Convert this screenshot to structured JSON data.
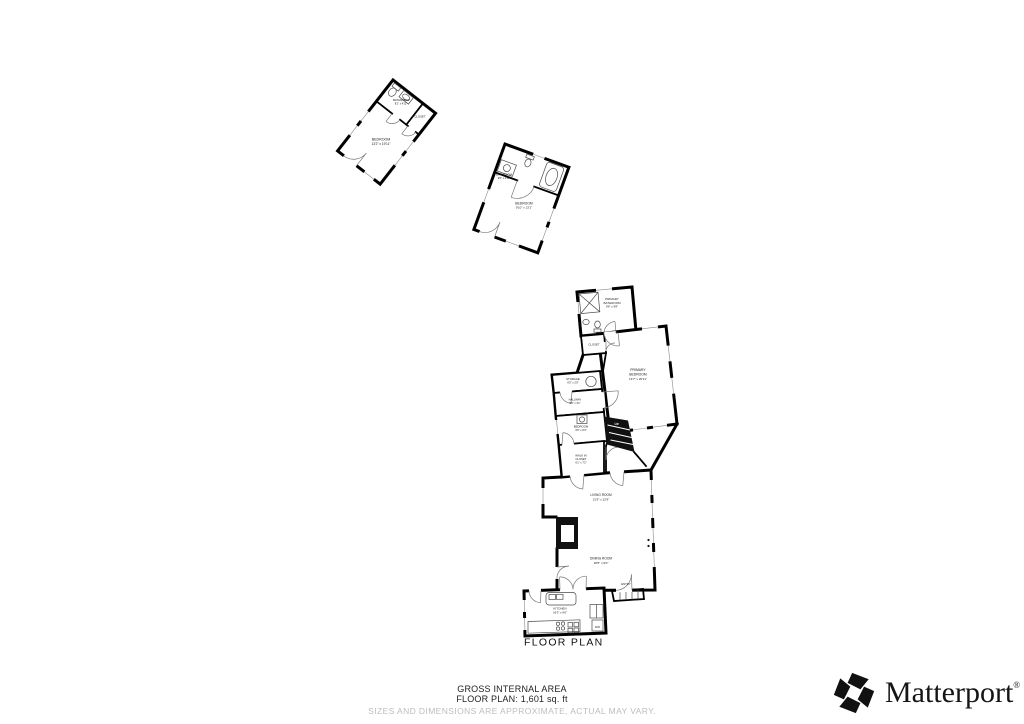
{
  "plan": {
    "colors": {
      "wall": "#000000",
      "fixture": "#4a4a4a",
      "window_line": "#8a8a8a",
      "door_arc": "#777777",
      "label": "#1a1a1a",
      "disclaimer": "#bdbdbd",
      "brand": "#111111"
    },
    "rooms": {
      "adu1_bathroom": {
        "name1": "BATHROOM",
        "name2": "",
        "dims": "8'2\" x 4'11\""
      },
      "adu1_closet": {
        "name1": "CLOSET",
        "name2": "",
        "dims": ""
      },
      "adu1_bedroom": {
        "name1": "BEDROOM",
        "name2": "",
        "dims": "13'2\" x 19'11\""
      },
      "adu2_bathroom": {
        "name1": "BATHROOM",
        "name2": "",
        "dims": "9'6\" x 4'11\""
      },
      "adu2_bedroom": {
        "name1": "BEDROOM",
        "name2": "",
        "dims": "9'10\" x 13'1\""
      },
      "primary_bathroom": {
        "name1": "PRIMARY",
        "name2": "BATHROOM",
        "dims": "9'6\" x 9'8\""
      },
      "primary_closet": {
        "name1": "CLOSET",
        "name2": "",
        "dims": ""
      },
      "primary_bedroom": {
        "name1": "PRIMARY",
        "name2": "BEDROOM",
        "dims": "14'7\" x 20'11\""
      },
      "storage": {
        "name1": "STORAGE",
        "name2": "",
        "dims": "6'5\" x 2'9\""
      },
      "hallway": {
        "name1": "HALLWAY",
        "name2": "",
        "dims": "9'9\" x 4'1\""
      },
      "bedroom_3": {
        "name1": "BEDROOM",
        "name2": "",
        "dims": "9'6\" x 6'3\""
      },
      "walk_in_closet": {
        "name1": "WALK IN",
        "name2": "CLOSET",
        "dims": "6'1\" x 7'2\""
      },
      "living_room": {
        "name1": "LIVING ROOM",
        "name2": "",
        "dims": "21'9\" x 22'9\""
      },
      "dining_room": {
        "name1": "DINING ROOM",
        "name2": "",
        "dims": "18'5\" x 9'0\""
      },
      "entry": {
        "name1": "ENTRY",
        "name2": "",
        "dims": ""
      },
      "kitchen": {
        "name1": "KITCHEN",
        "name2": "",
        "dims": "16'3\" x 9'6\""
      }
    },
    "labels": {
      "up": "UP",
      "dw": "DW",
      "floor_plan": "FLOOR PLAN"
    }
  },
  "footer": {
    "area_title": "GROSS INTERNAL AREA",
    "area_value": "FLOOR PLAN: 1,601 sq. ft",
    "disclaimer": "SIZES AND DIMENSIONS ARE APPROXIMATE, ACTUAL MAY VARY."
  },
  "brand": {
    "name": "Matterport",
    "mark": "®"
  }
}
